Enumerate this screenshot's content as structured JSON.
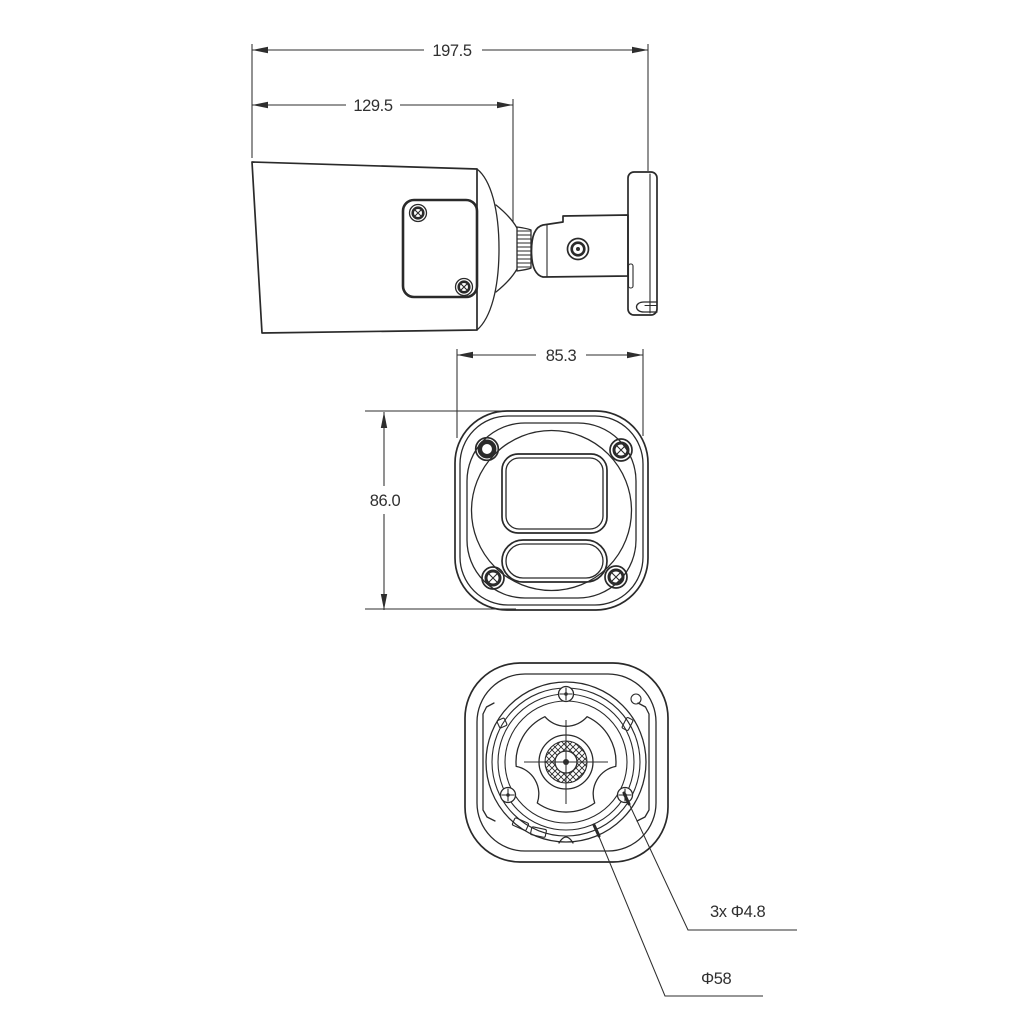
{
  "drawing": {
    "side_view": {
      "overall_length": "197.5",
      "body_length": "129.5"
    },
    "front_view": {
      "width": "85.3",
      "height": "86.0"
    },
    "rear_view": {
      "screw_holes": "3x Φ4.8",
      "mount_diameter": "Φ58"
    }
  },
  "colors": {
    "background": "#ffffff",
    "line": "#2a2a2a",
    "text": "#303030"
  }
}
